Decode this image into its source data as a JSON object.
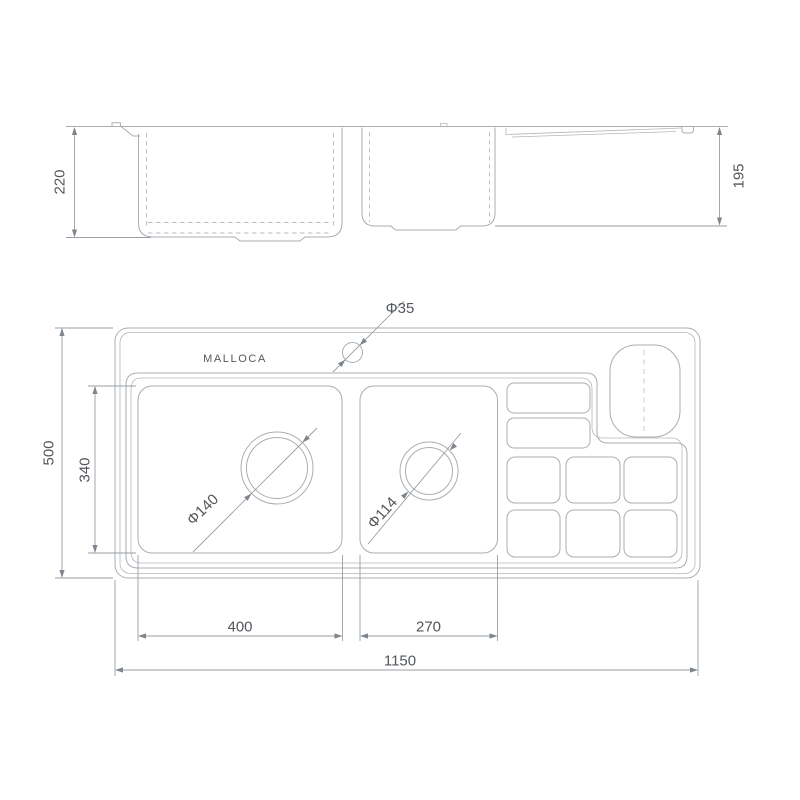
{
  "colors": {
    "background": "#ffffff",
    "outline": "#a9aeb3",
    "hidden_line": "#b7bcc0",
    "dimension_line": "#999fa5",
    "text": "#53575c"
  },
  "brand": {
    "label": "MALLOCA"
  },
  "elevation_view": {
    "dimensions": {
      "bowl_depth_left": {
        "label": "220",
        "value": 220
      },
      "bowl_depth_right": {
        "label": "195",
        "value": 195
      }
    }
  },
  "plan_view": {
    "holes": {
      "tap_hole": {
        "label": "Φ35",
        "diameter": 35
      },
      "bowl1_drain": {
        "label": "Φ140",
        "diameter": 140
      },
      "bowl2_drain": {
        "label": "Φ114",
        "diameter": 114
      }
    },
    "dimensions": {
      "overall_width": {
        "label": "1150",
        "value": 1150
      },
      "overall_depth": {
        "label": "500",
        "value": 500
      },
      "bowl_inner_depth": {
        "label": "340",
        "value": 340
      },
      "bowl1_width": {
        "label": "400",
        "value": 400
      },
      "bowl2_width": {
        "label": "270",
        "value": 270
      }
    }
  }
}
